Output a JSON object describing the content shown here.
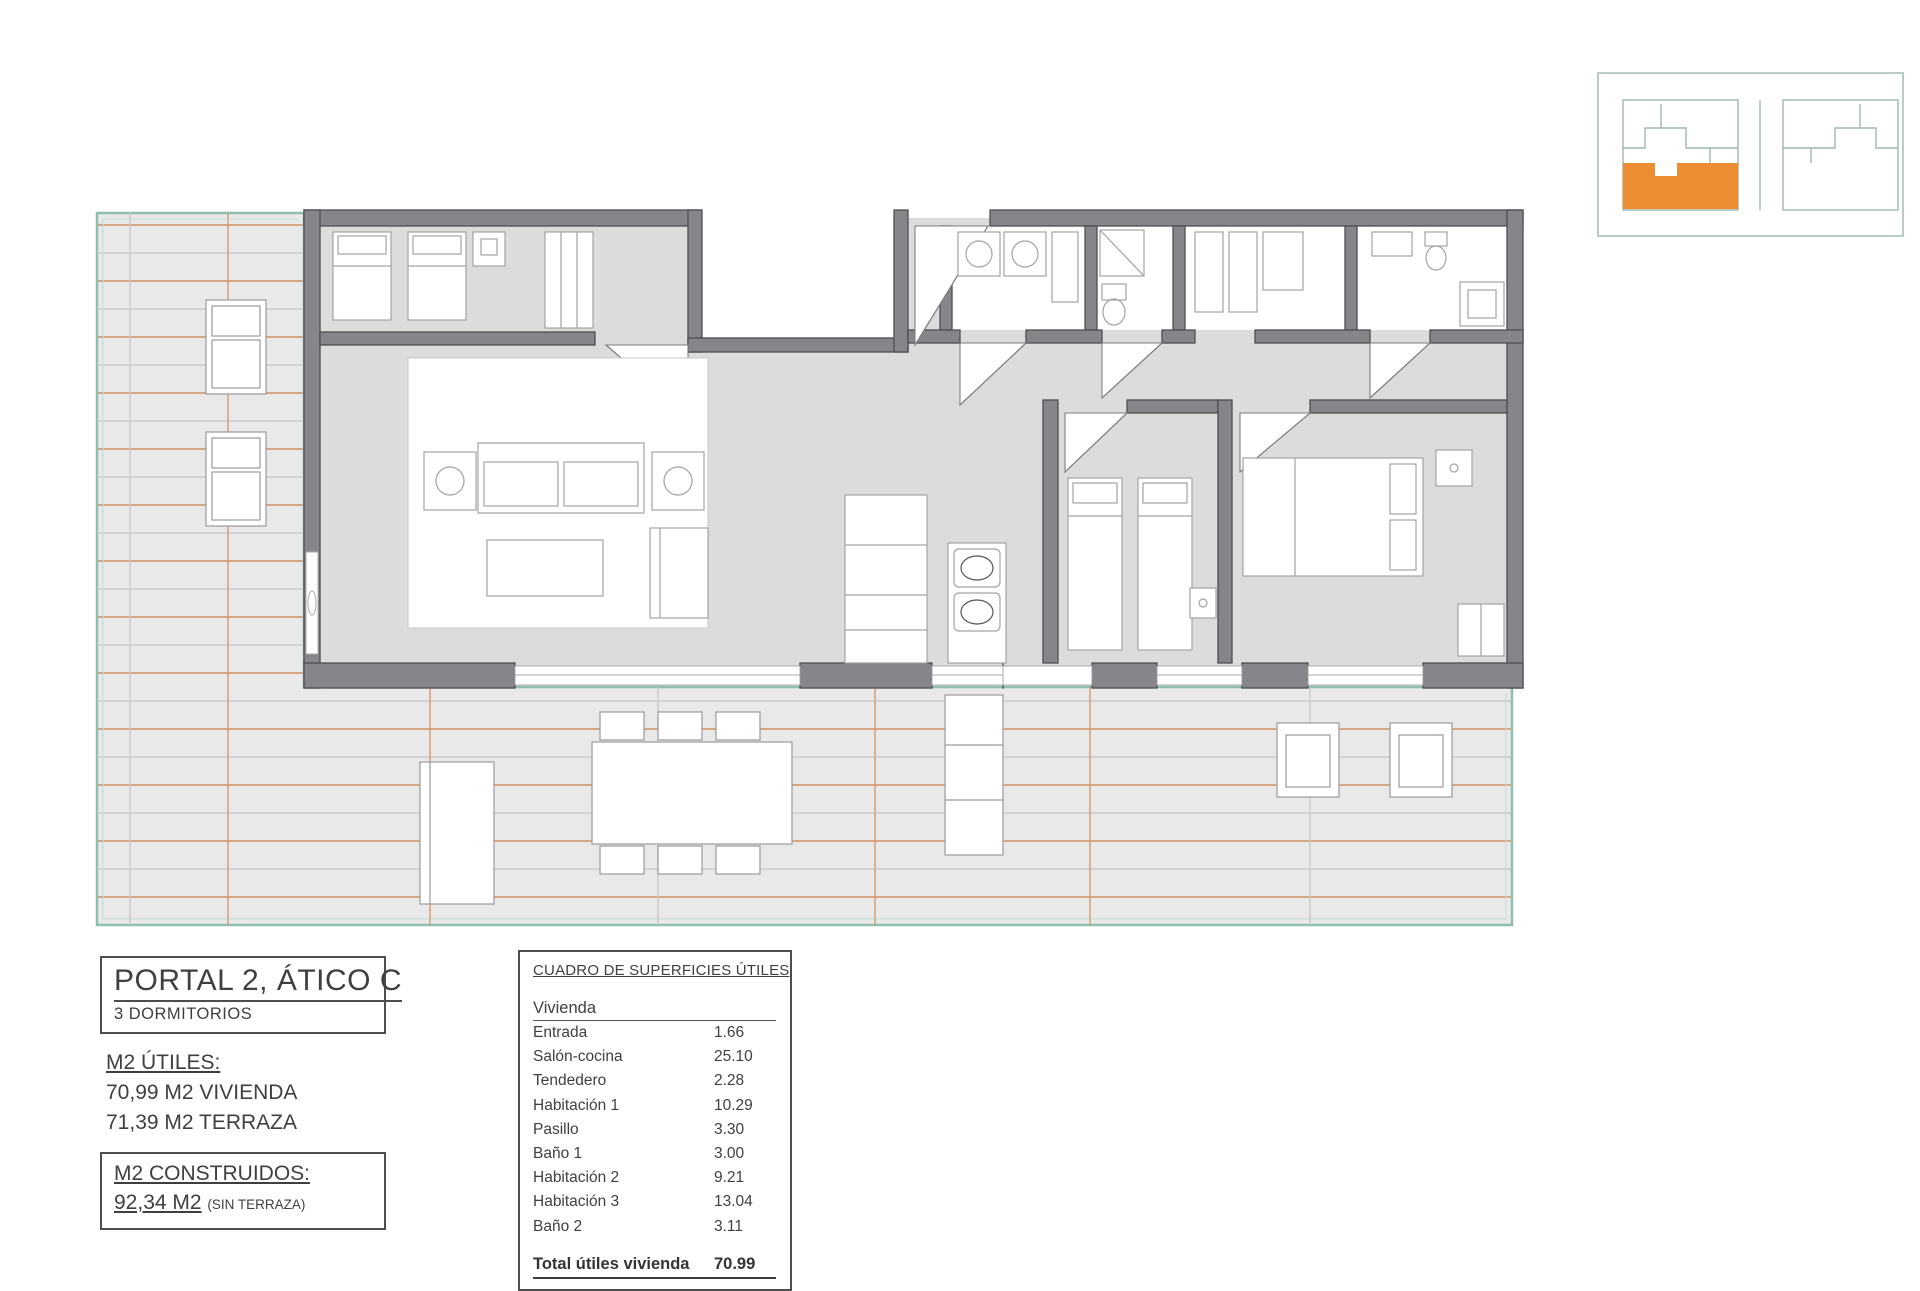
{
  "plan": {
    "title": "PORTAL 2, ÁTICO C",
    "subtitle": "3 DORMITORIOS"
  },
  "m2_utiles": {
    "heading": "M2 ÚTILES:",
    "lines": [
      "70,99 M2 VIVIENDA",
      "71,39 M2 TERRAZA"
    ]
  },
  "m2_construidos": {
    "heading": "M2 CONSTRUIDOS:",
    "value": "92,34 M2",
    "note": "(SIN TERRAZA)"
  },
  "surfaces_table": {
    "title": "CUADRO DE SUPERFICIES ÚTILES",
    "section": "Vivienda",
    "rows": [
      {
        "label": "Entrada",
        "value": "1.66"
      },
      {
        "label": "Salón-cocina",
        "value": "25.10"
      },
      {
        "label": "Tendedero",
        "value": "2.28"
      },
      {
        "label": "Habitación 1",
        "value": "10.29"
      },
      {
        "label": "Pasillo",
        "value": "3.30"
      },
      {
        "label": "Baño 1",
        "value": "3.00"
      },
      {
        "label": "Habitación 2",
        "value": "9.21"
      },
      {
        "label": "Habitación 3",
        "value": "13.04"
      },
      {
        "label": "Baño 2",
        "value": "3.11"
      }
    ],
    "total_label": "Total útiles vivienda",
    "total_value": "70.99"
  },
  "colors": {
    "wall": "#85858a",
    "room_floor": "#dcdcdd",
    "terrace_floor": "#e9e9ea",
    "tile_joint_orange": "#cf8f60",
    "tile_joint_gray": "#c6c6ca",
    "terrace_border": "#8fbfae",
    "locator_highlight": "#ec8c33"
  }
}
